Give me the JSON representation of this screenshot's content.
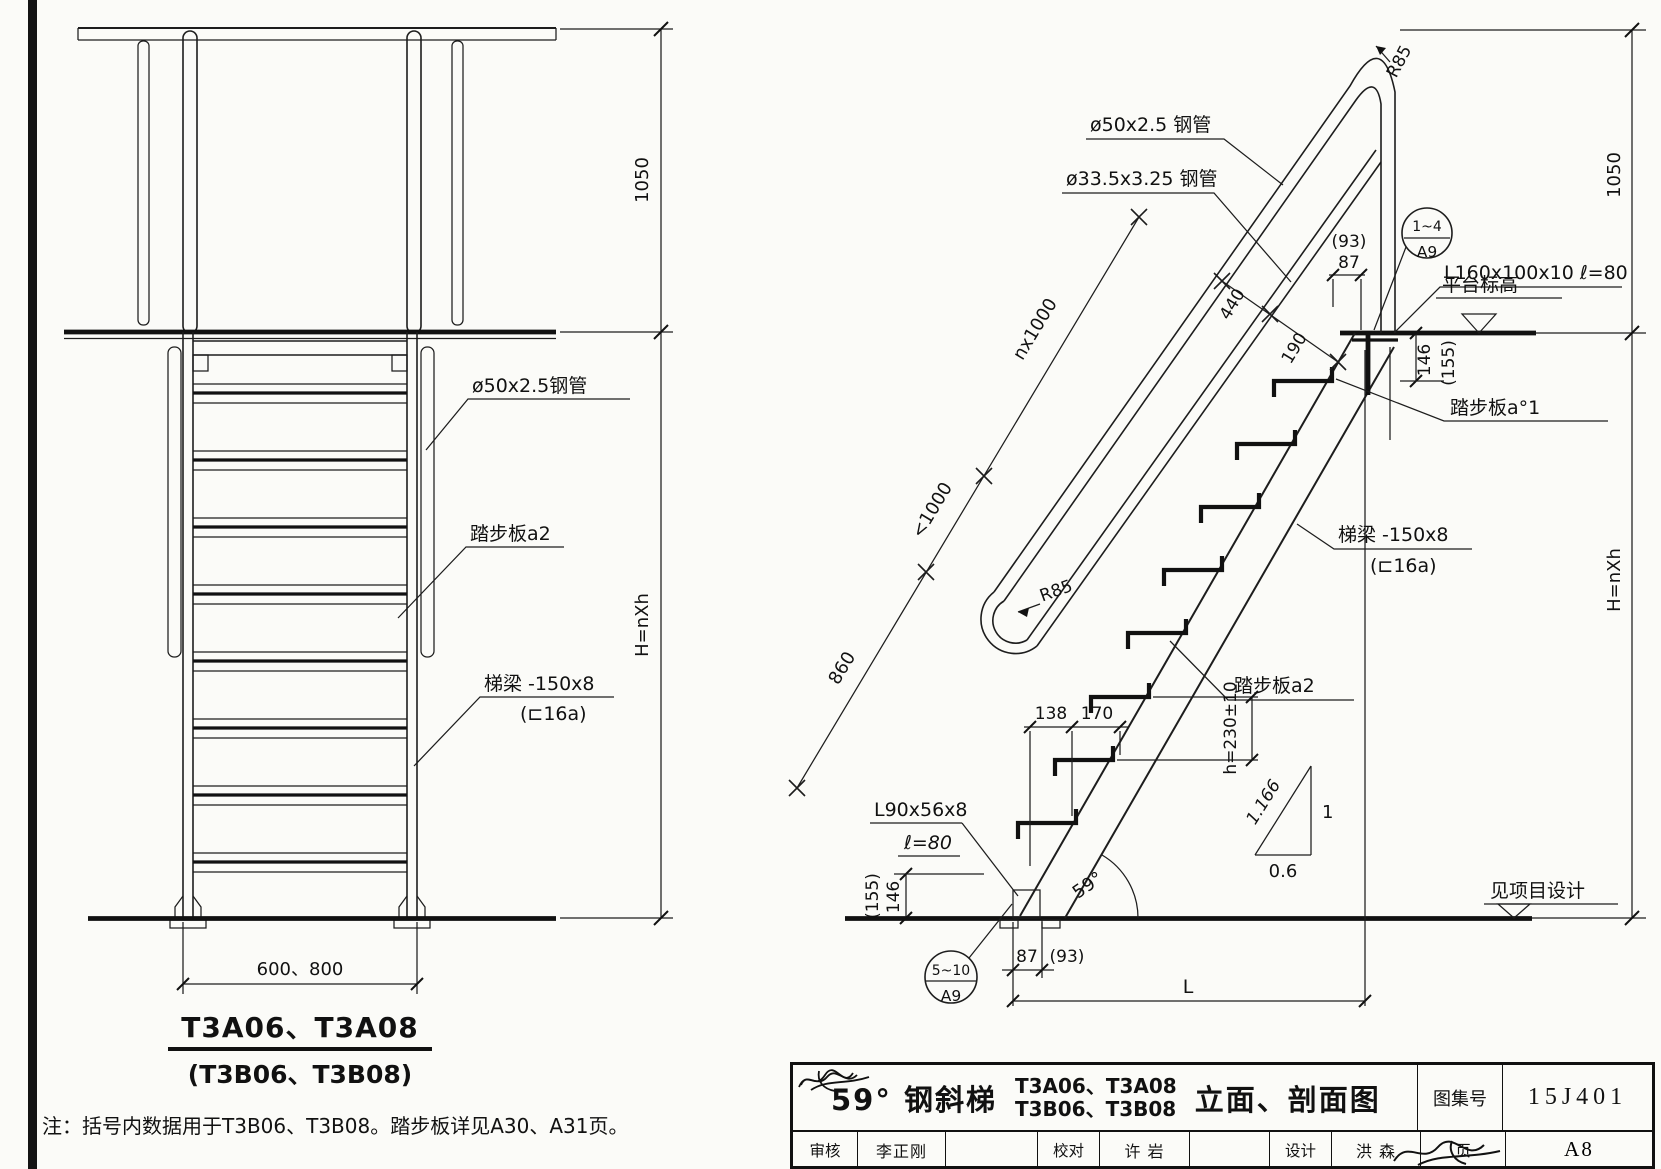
{
  "left_view": {
    "dim_height_top": "1050",
    "dim_height_main": "H=nXh",
    "label_rail_pipe": "ø50x2.5钢管",
    "label_tread": "踏步板a2",
    "label_stringer_line1": "梯梁 -150x8",
    "label_stringer_line2": "(⊏16a)",
    "dim_width": "600、800",
    "title_line1": "T3A06、T3A08",
    "title_line2": "(T3B06、T3B08)"
  },
  "right_view": {
    "label_rail_pipe": "ø50x2.5 钢管",
    "label_mid_rail_pipe": "ø33.5x3.25 钢管",
    "radius_top": "R85",
    "radius_bottom": "R85",
    "dim_rail_height": "1050",
    "dim_height_main": "H=nXh",
    "dim_run_top": "nx1000",
    "dim_run_mid": "<1000",
    "dim_run_bottom": "860",
    "dim_440": "440",
    "dim_190": "190",
    "dim_top_93": "(93)",
    "dim_top_87": "87",
    "callout_top_upper": "1~4",
    "callout_top_lower": "A9",
    "label_angle_cleat": "L160x100x10 ℓ=80",
    "label_platform_level": "平台标高",
    "dim_146_top": "146",
    "dim_155_top": "(155)",
    "label_tread_a1": "踏步板a°1",
    "label_stringer_line1": "梯梁 -150x8",
    "label_stringer_line2": "(⊏16a)",
    "label_tread_a2": "踏步板a2",
    "dim_step_height": "h=230±10",
    "dim_138": "138",
    "dim_170": "170",
    "slope_hyp": "1.166",
    "slope_rise": "1",
    "slope_run": "0.6",
    "label_base_angle_line1": "L90x56x8",
    "label_base_angle_line2": "ℓ=80",
    "dim_146_bottom": "146",
    "dim_155_bottom": "(155)",
    "angle": "59°",
    "callout_bottom_upper": "5~10",
    "callout_bottom_lower": "A9",
    "dim_bottom_87": "87",
    "dim_bottom_93": "(93)",
    "dim_length": "L",
    "label_floor_level": "见项目设计"
  },
  "note": "注：括号内数据用于T3B06、T3B08。踏步板详见A30、A31页。",
  "title_block": {
    "drawing_type": "59° 钢斜梯",
    "models_line1": "T3A06、T3A08",
    "models_line2": "T3B06、T3B08",
    "drawing_title": "立面、剖面图",
    "atlas_label": "图集号",
    "atlas_number": "15J401",
    "reviewer_label": "审核",
    "reviewer_name": "李正刚",
    "checker_label": "校对",
    "checker_name": "许 岩",
    "designer_label": "设计",
    "designer_name": "洪 森",
    "page_label": "页",
    "page_number": "A8"
  }
}
